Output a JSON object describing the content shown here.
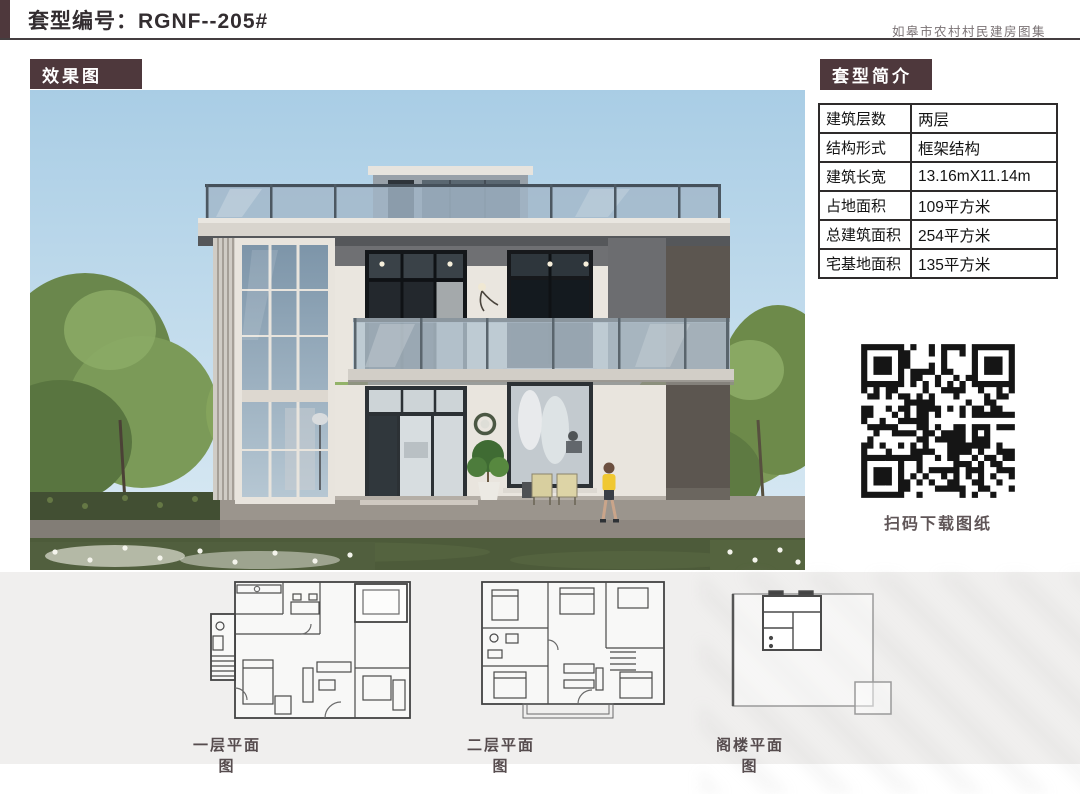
{
  "header": {
    "title": "套型编号：RGNF--205#",
    "right_note": "如皋市农村村民建房图集"
  },
  "sections": {
    "render_label": "效果图",
    "intro_label": "套型简介",
    "plan_label": "套型平面"
  },
  "intro_table": {
    "rows": [
      {
        "label": "建筑层数",
        "value": "两层"
      },
      {
        "label": "结构形式",
        "value": "框架结构"
      },
      {
        "label": "建筑长宽",
        "value": "13.16mX11.14m"
      },
      {
        "label": "占地面积",
        "value": "109平方米"
      },
      {
        "label": "总建筑面积",
        "value": "254平方米"
      },
      {
        "label": "宅基地面积",
        "value": "135平方米"
      }
    ]
  },
  "qr": {
    "caption": "扫码下载图纸"
  },
  "plans": [
    {
      "caption": "一层平面图"
    },
    {
      "caption": "二层平面图"
    },
    {
      "caption": "阁楼平面图"
    }
  ],
  "colors": {
    "accent_brown": "#4e383c",
    "page_bg": "#ffffff",
    "bottom_bg": "#f0efee"
  }
}
